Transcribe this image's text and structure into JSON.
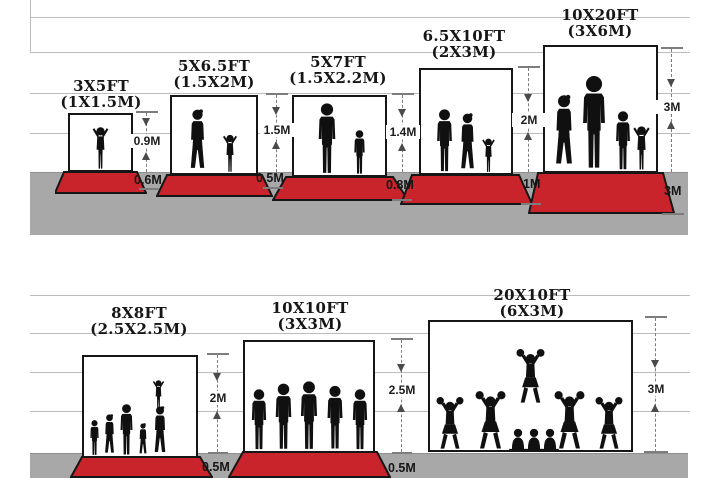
{
  "colors": {
    "carpet_red": "#c9232b",
    "floor_gray": "#a8a8a8",
    "grid_line": "#bcbcbc",
    "ink": "#161616",
    "silhouette": "#101010",
    "dim_line": "#7d7d7d"
  },
  "panels": [
    {
      "title": "3X5FT",
      "subtitle": "(1X1.5M)",
      "wall": "0.9M",
      "floor": "0.6M",
      "figures": "toddler with arms out"
    },
    {
      "title": "5X6.5FT",
      "subtitle": "(1.5X2M)",
      "wall": "1.5M",
      "floor": "0.5M",
      "figures": "woman and child raising arm"
    },
    {
      "title": "5X7FT",
      "subtitle": "(1.5X2.2M)",
      "wall": "1.4M",
      "floor": "0.8M",
      "figures": "man and boy"
    },
    {
      "title": "6.5X10FT",
      "subtitle": "(2X3M)",
      "wall": "2M",
      "floor": "1M",
      "figures": "man, woman and child"
    },
    {
      "title": "10X20FT",
      "subtitle": "(3X6M)",
      "wall": "3M",
      "floor": "3M",
      "figures": "family of four"
    },
    {
      "title": "8X8FT",
      "subtitle": "(2.5X2.5M)",
      "wall": "2M",
      "floor": "0.5M",
      "figures": "family with child on shoulders"
    },
    {
      "title": "10X10FT",
      "subtitle": "(3X3M)",
      "wall": "2.5M",
      "floor": "0.5M",
      "figures": "team of five men"
    },
    {
      "title": "20X10FT",
      "subtitle": "(6X3M)",
      "wall": "3M",
      "floor": null,
      "figures": "cheerleading squad with pyramid"
    }
  ]
}
